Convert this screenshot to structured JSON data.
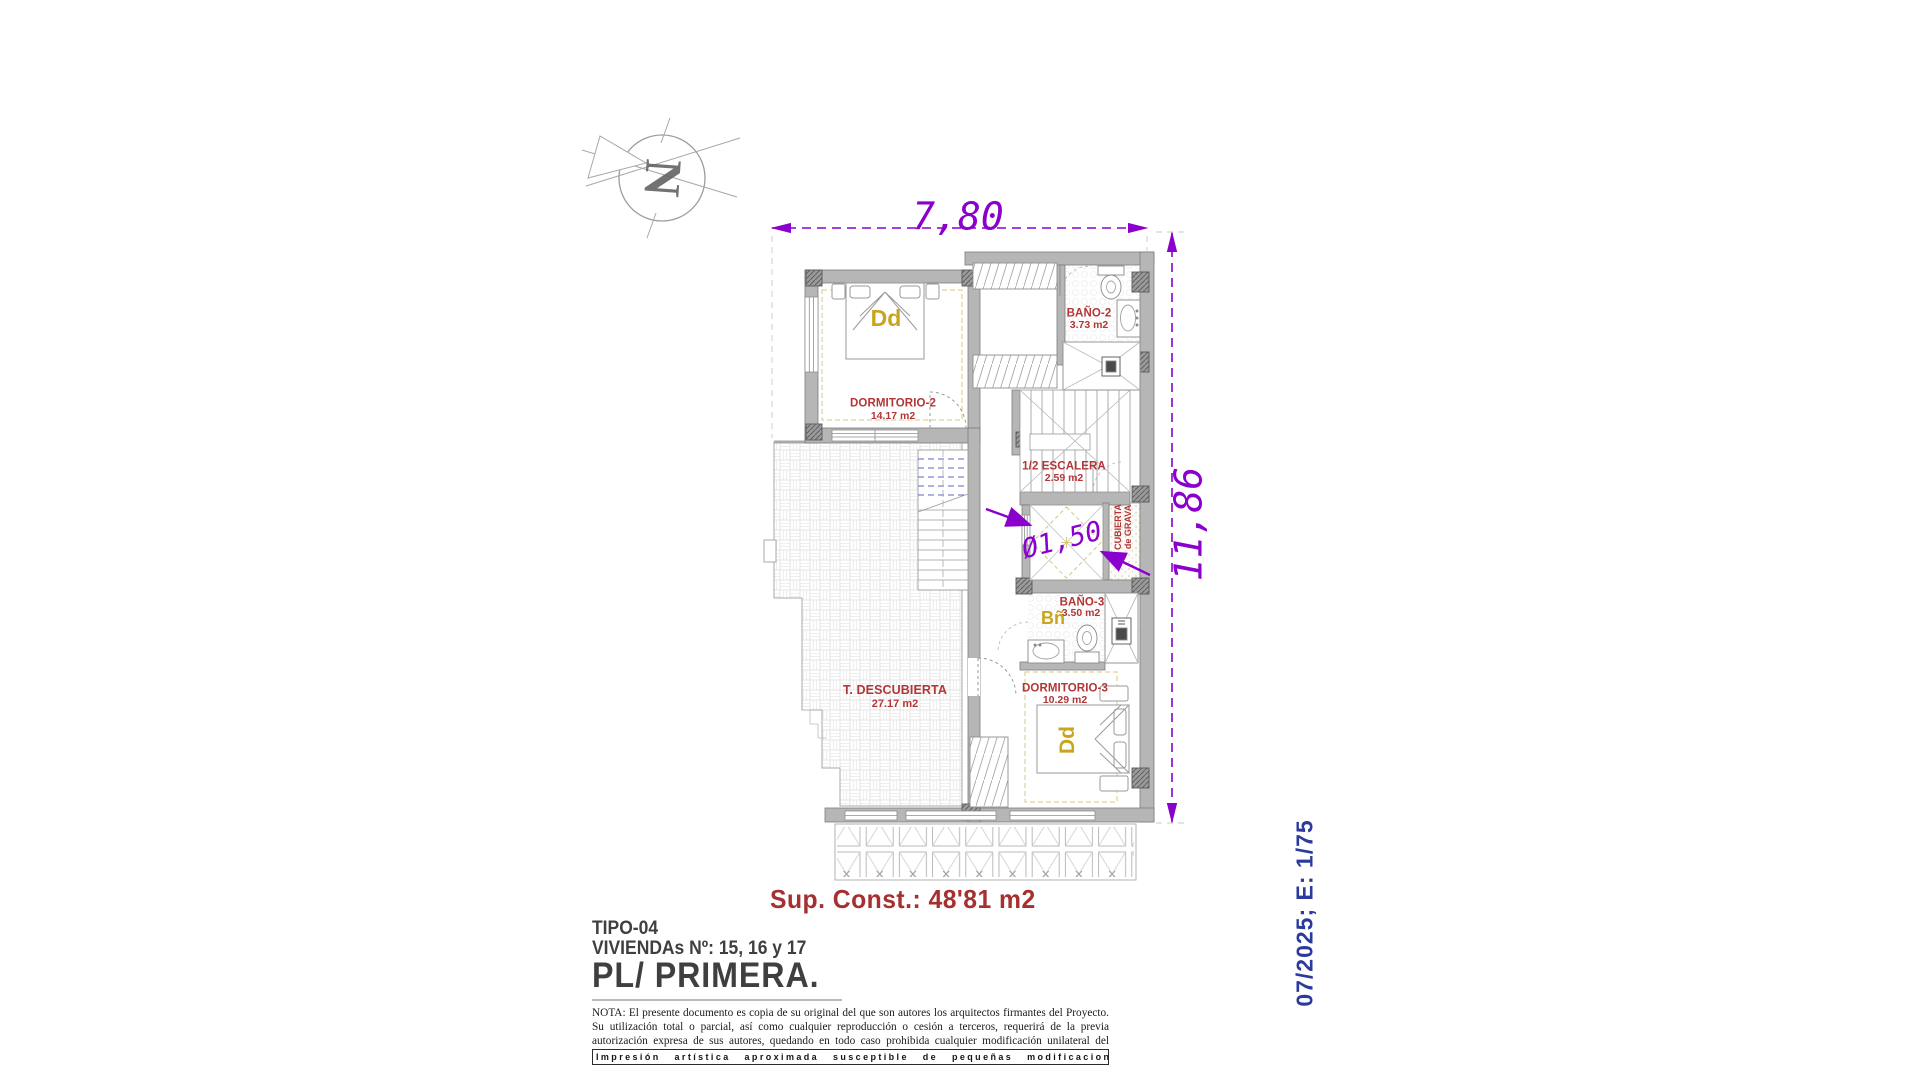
{
  "plan": {
    "north": "N",
    "dims": {
      "width": "7,80",
      "height": "11,86",
      "shaft": "Ø1,50"
    },
    "rooms": {
      "dormitorio2": {
        "name": "DORMITORIO-2",
        "area": "14.17 m2",
        "tag": "Dd"
      },
      "bano2": {
        "name": "BAÑO-2",
        "area": "3.73 m2"
      },
      "escalera": {
        "name": "1/2 ESCALERA",
        "area": "2.59 m2"
      },
      "cubierta_grava": {
        "line1": "CUBIERTA",
        "line2": "de GRAVA"
      },
      "bano3": {
        "name": "BAÑO-3",
        "area": "3.50 m2",
        "tag": "Bñ"
      },
      "dormitorio3": {
        "name": "DORMITORIO-3",
        "area": "10.29 m2",
        "tag": "Dd"
      },
      "terraza": {
        "name": "T. DESCUBIERTA",
        "area": "27.17 m2"
      }
    },
    "summary": {
      "sup_const": "Sup. Const.: 48'81 m2"
    },
    "title_block": {
      "tipo": "TIPO-04",
      "viviendas": "VIVIENDAs Nº: 15, 16 y 17",
      "planta": "PL/ PRIMERA."
    },
    "stamp": {
      "text": "07/2025; E: 1/75"
    },
    "legal": {
      "note": "NOTA: El presente documento es copia de su original del que son autores los arquitectos firmantes del Proyecto. Su utilización total o parcial, así como cualquier reproducción o cesión a terceros, requerirá de la previa autorización expresa de sus autores, quedando en todo caso prohibida cualquier modificación unilateral del mismo.",
      "disclaimer": "Impresión artística aproximada susceptible de pequeñas modificaciones."
    },
    "colors": {
      "dimension": "#8a00cc",
      "room_label": "#b23636",
      "tag": "#c9a41f",
      "stamp": "#2b3a9c",
      "wall": "#b6b6b6"
    }
  }
}
